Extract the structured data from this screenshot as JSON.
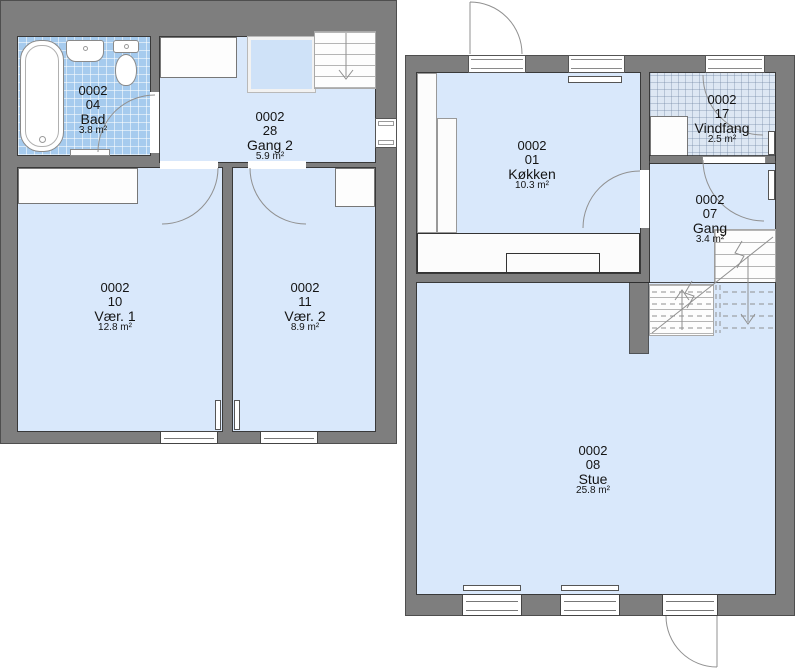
{
  "plan_title": "Floor plan 0002",
  "rooms": {
    "bad": {
      "code": "0002",
      "number": "04",
      "name": "Bad",
      "area": "3.8 m²"
    },
    "gang2": {
      "code": "0002",
      "number": "28",
      "name": "Gang 2",
      "area": "5.9 m²"
    },
    "vaer1": {
      "code": "0002",
      "number": "10",
      "name": "Vær. 1",
      "area": "12.8 m²"
    },
    "vaer2": {
      "code": "0002",
      "number": "11",
      "name": "Vær. 2",
      "area": "8.9 m²"
    },
    "koekken": {
      "code": "0002",
      "number": "01",
      "name": "Køkken",
      "area": "10.3 m²"
    },
    "vindfang": {
      "code": "0002",
      "number": "17",
      "name": "Vindfang",
      "area": "2.5 m²"
    },
    "gang": {
      "code": "0002",
      "number": "07",
      "name": "Gang",
      "area": "3.4 m²"
    },
    "stue": {
      "code": "0002",
      "number": "08",
      "name": "Stue",
      "area": "25.8 m²"
    }
  },
  "colors": {
    "wall": "#7e7e7e",
    "floor": "#d9e8fb",
    "bath_tile": "#a6cbee",
    "entry_tile": "#dde7f3",
    "fixture": "#ffffff",
    "outline": "#3c3c3c",
    "annotation": "#909090"
  }
}
